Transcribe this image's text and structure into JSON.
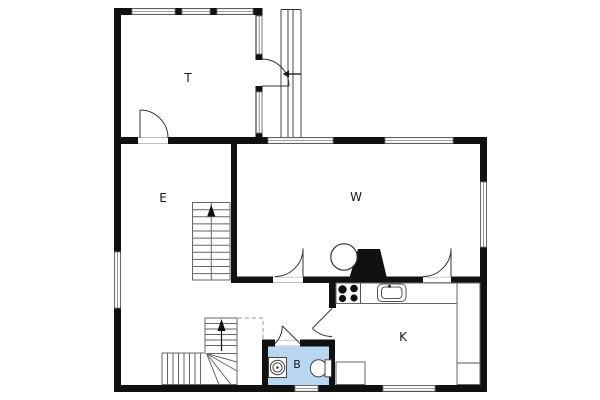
{
  "page": {
    "background": "#ffffff",
    "type": "architectural floor plan"
  },
  "rooms": {
    "t": {
      "label": "T"
    },
    "e": {
      "label": "E"
    },
    "w": {
      "label": "W"
    },
    "k": {
      "label": "K"
    },
    "b": {
      "label": "B"
    }
  },
  "markers": {
    "stair_direction": "up",
    "entrance_direction": "left"
  },
  "colors": {
    "wall": "#111111",
    "window_frame": "#7a7a7a",
    "door_line": "#333333",
    "stair_line": "#666666",
    "fixture_line": "#444444",
    "bathroom_fill": "#b9d7f1",
    "label_text": "#1a1a1a"
  }
}
